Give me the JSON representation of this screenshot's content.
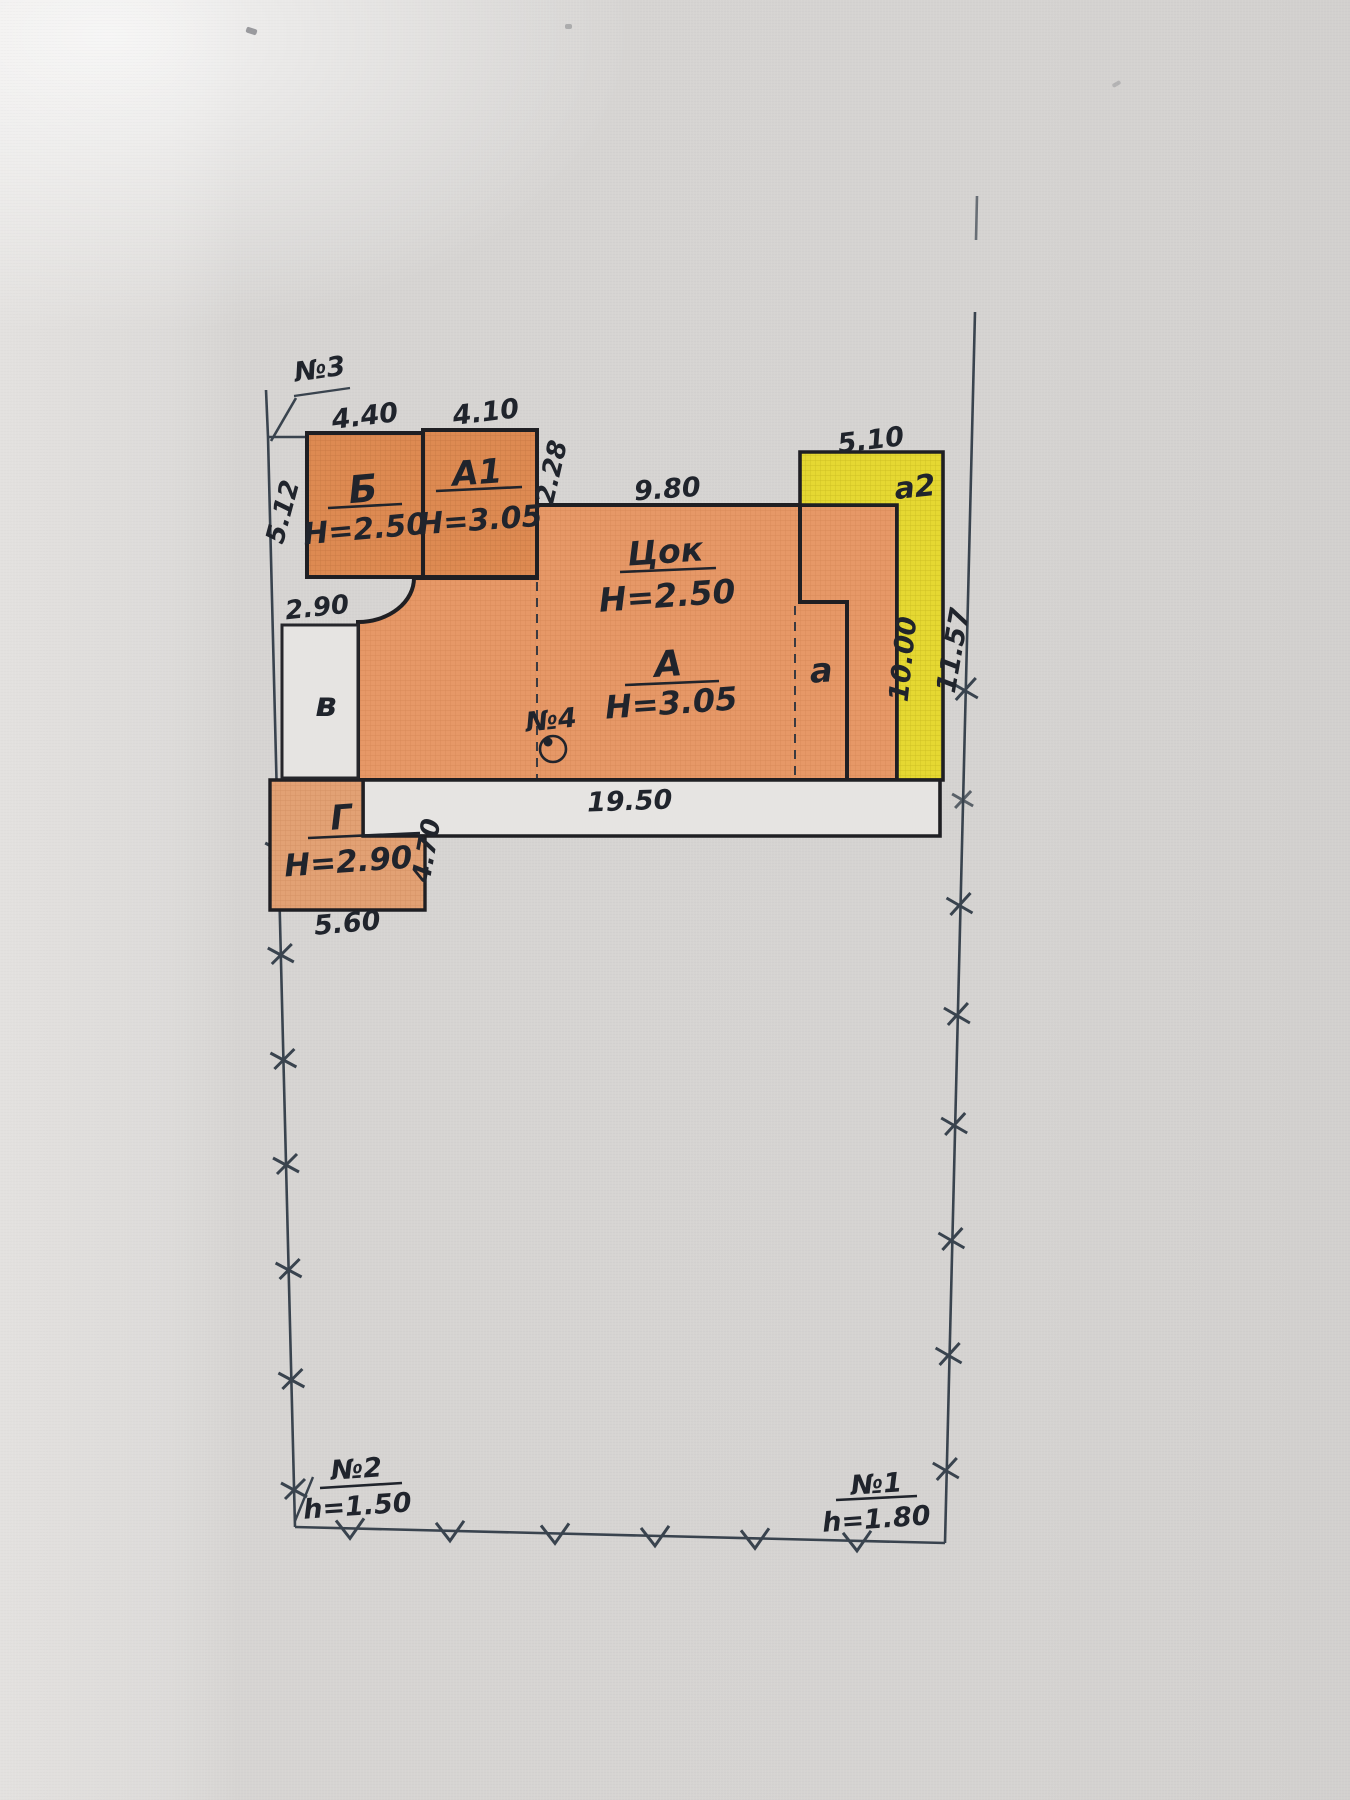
{
  "plan": {
    "blocks": {
      "b": {
        "label": "Б",
        "height": "Н=2.50"
      },
      "a1": {
        "label": "А1",
        "height": "Н=3.05"
      },
      "cok": {
        "label": "Цок",
        "height": "Н=2.50"
      },
      "a": {
        "label": "А",
        "height": "Н=3.05"
      },
      "annex_a": {
        "label": "а"
      },
      "annex_a2": {
        "label": "а2"
      },
      "v": {
        "label": "в"
      },
      "g": {
        "label": "Г",
        "height": "Н=2.90"
      }
    },
    "dimensions": {
      "b_top": "4.40",
      "a1_top": "4.10",
      "a1_right": "2.28",
      "b_left": "5.12",
      "v_top": "2.90",
      "main_top": "9.80",
      "a2_top": "5.10",
      "a2_inner": "10.00",
      "a2_outer": "11.57",
      "main_bottom": "19.50",
      "g_right": "4.70",
      "g_bottom": "5.60"
    },
    "markers": {
      "n3": "№3",
      "n4": "№4",
      "n2": {
        "label": "№2",
        "height": "h=1.50"
      },
      "n1": {
        "label": "№1",
        "height": "h=1.80"
      }
    },
    "colors": {
      "block_orange": "#dd8a52",
      "main_orange": "#e69867",
      "g_orange": "#e2a174",
      "annex_yellow": "#e5d832",
      "outline": "#1f1f23",
      "boundary": "#39434e",
      "text": "#20242c",
      "paper": "#d6d4d2"
    }
  }
}
